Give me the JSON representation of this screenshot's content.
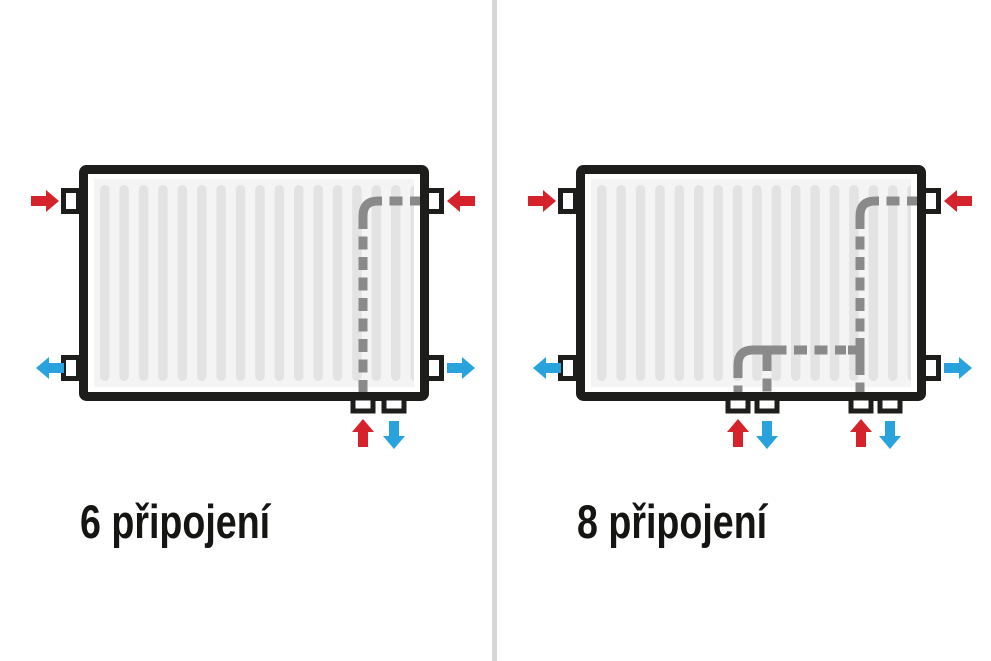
{
  "colors": {
    "inlet": "#d6232b",
    "outlet": "#29a3dd",
    "pipe": "#8a8a8a",
    "outline": "#1d1d1b",
    "fin": "#e3e3e3",
    "panel-bg": "#f4f4f4",
    "divider": "#d6d6d6",
    "label": "#151513",
    "background": "#ffffff"
  },
  "panels": [
    {
      "label": "6 připojení",
      "side_connections": [
        {
          "position": "top-left",
          "type": "inlet"
        },
        {
          "position": "top-right",
          "type": "inlet"
        },
        {
          "position": "bottom-left",
          "type": "outlet"
        },
        {
          "position": "bottom-right",
          "type": "outlet"
        }
      ],
      "bottom_connections": [
        {
          "position": "bottom-right",
          "types": [
            "inlet",
            "outlet"
          ]
        }
      ]
    },
    {
      "label": "8 připojení",
      "side_connections": [
        {
          "position": "top-left",
          "type": "inlet"
        },
        {
          "position": "top-right",
          "type": "inlet"
        },
        {
          "position": "bottom-left",
          "type": "outlet"
        },
        {
          "position": "bottom-right",
          "type": "outlet"
        }
      ],
      "bottom_connections": [
        {
          "position": "bottom-center",
          "types": [
            "inlet",
            "outlet"
          ]
        },
        {
          "position": "bottom-right",
          "types": [
            "inlet",
            "outlet"
          ]
        }
      ]
    }
  ]
}
